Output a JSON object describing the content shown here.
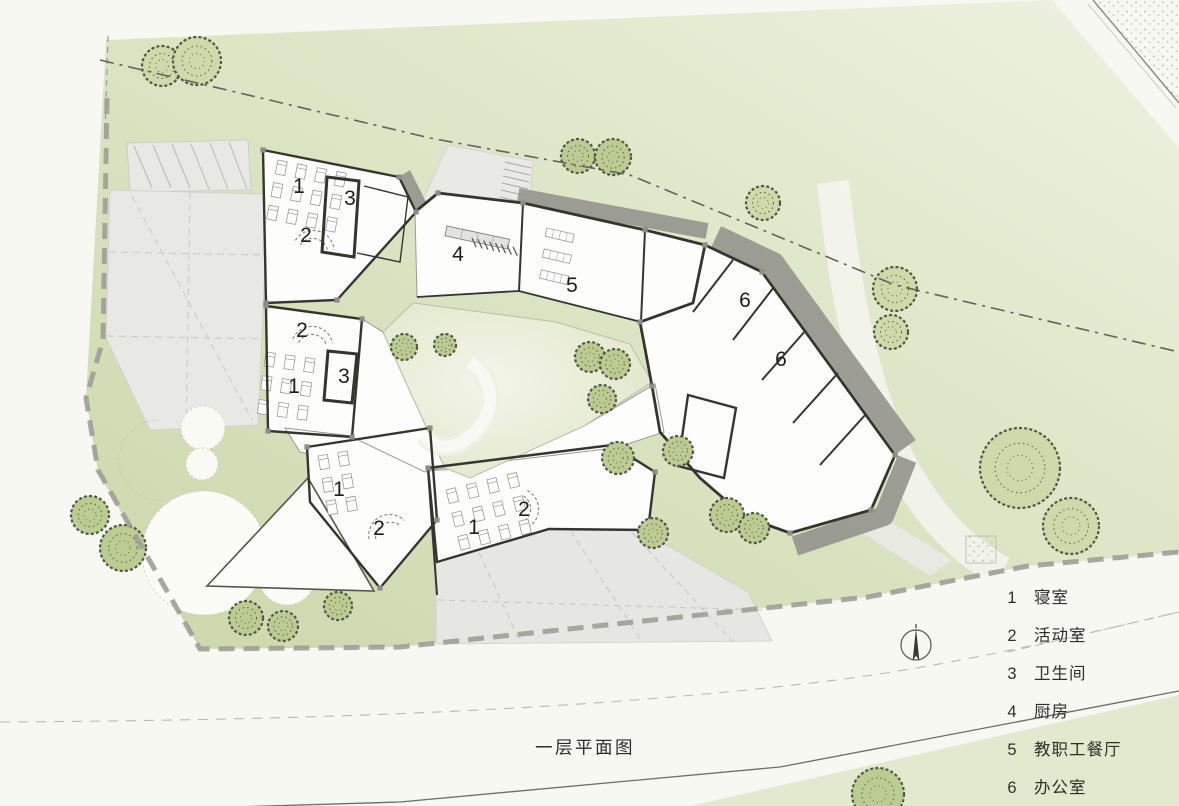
{
  "drawing": {
    "caption": "一层平面图",
    "type": "architectural-site-floor-plan"
  },
  "legend": {
    "items": [
      {
        "num": "1",
        "label": "寝室"
      },
      {
        "num": "2",
        "label": "活动室"
      },
      {
        "num": "3",
        "label": "卫生间"
      },
      {
        "num": "4",
        "label": "厨房"
      },
      {
        "num": "5",
        "label": "教职工餐厅"
      },
      {
        "num": "6",
        "label": "办公室"
      }
    ]
  },
  "room_labels": [
    {
      "num": "1",
      "x": 299,
      "y": 187
    },
    {
      "num": "3",
      "x": 350,
      "y": 199
    },
    {
      "num": "2",
      "x": 306,
      "y": 236
    },
    {
      "num": "4",
      "x": 458,
      "y": 255
    },
    {
      "num": "5",
      "x": 572,
      "y": 286
    },
    {
      "num": "6",
      "x": 745,
      "y": 301
    },
    {
      "num": "6",
      "x": 781,
      "y": 360
    },
    {
      "num": "2",
      "x": 302,
      "y": 331
    },
    {
      "num": "3",
      "x": 344,
      "y": 377
    },
    {
      "num": "1",
      "x": 294,
      "y": 387
    },
    {
      "num": "1",
      "x": 339,
      "y": 490
    },
    {
      "num": "2",
      "x": 379,
      "y": 529
    },
    {
      "num": "1",
      "x": 474,
      "y": 528
    },
    {
      "num": "2",
      "x": 524,
      "y": 510
    }
  ],
  "site": {
    "north_arrow": {
      "x": 916,
      "y": 645
    },
    "trees": [
      {
        "x": 162,
        "y": 66,
        "r": 20,
        "s": "a"
      },
      {
        "x": 197,
        "y": 61,
        "r": 24,
        "s": "a"
      },
      {
        "x": 578,
        "y": 156,
        "r": 17,
        "s": "b"
      },
      {
        "x": 613,
        "y": 157,
        "r": 18,
        "s": "b"
      },
      {
        "x": 763,
        "y": 203,
        "r": 17,
        "s": "a"
      },
      {
        "x": 895,
        "y": 289,
        "r": 22,
        "s": "a"
      },
      {
        "x": 891,
        "y": 332,
        "r": 17,
        "s": "a"
      },
      {
        "x": 404,
        "y": 347,
        "r": 13,
        "s": "b"
      },
      {
        "x": 445,
        "y": 345,
        "r": 11,
        "s": "b"
      },
      {
        "x": 590,
        "y": 357,
        "r": 15,
        "s": "b"
      },
      {
        "x": 615,
        "y": 364,
        "r": 15,
        "s": "b"
      },
      {
        "x": 602,
        "y": 399,
        "r": 14,
        "s": "b"
      },
      {
        "x": 618,
        "y": 458,
        "r": 16,
        "s": "b"
      },
      {
        "x": 678,
        "y": 451,
        "r": 15,
        "s": "b"
      },
      {
        "x": 653,
        "y": 533,
        "r": 15,
        "s": "b"
      },
      {
        "x": 727,
        "y": 515,
        "r": 17,
        "s": "b"
      },
      {
        "x": 754,
        "y": 528,
        "r": 15,
        "s": "b"
      },
      {
        "x": 1020,
        "y": 468,
        "r": 40,
        "s": "a"
      },
      {
        "x": 1071,
        "y": 526,
        "r": 28,
        "s": "a"
      },
      {
        "x": 90,
        "y": 515,
        "r": 19,
        "s": "b"
      },
      {
        "x": 123,
        "y": 548,
        "r": 23,
        "s": "b"
      },
      {
        "x": 246,
        "y": 618,
        "r": 17,
        "s": "b"
      },
      {
        "x": 283,
        "y": 626,
        "r": 15,
        "s": "b"
      },
      {
        "x": 338,
        "y": 606,
        "r": 14,
        "s": "b"
      },
      {
        "x": 878,
        "y": 794,
        "r": 26,
        "s": "b"
      }
    ]
  },
  "colors": {
    "lawn": "#d8e2bc",
    "lawn_light": "#eef2e0",
    "courtyard": "#e9eed9",
    "paving": "#e8e8e4",
    "shadow": "#96968e",
    "wall": "#35352f",
    "tree_light": "#cfdaab",
    "tree_dark": "#bccb92",
    "boundary_dash": "#9e9e97",
    "text": "#2e2e2b"
  }
}
